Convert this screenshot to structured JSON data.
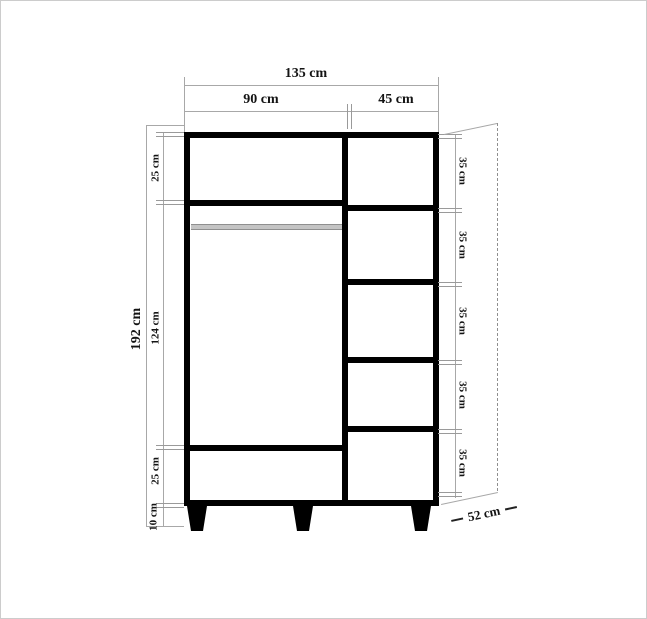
{
  "dimensions": {
    "top": {
      "total_width": "135 cm",
      "left_section_width": "90 cm",
      "right_section_width": "45 cm"
    },
    "left": {
      "total_height": "192 cm",
      "top_compartment": "25 cm",
      "middle_compartment": "124 cm",
      "bottom_compartment": "25 cm",
      "legs_height": "10 cm"
    },
    "right": {
      "shelves": [
        "35 cm",
        "35 cm",
        "35 cm",
        "35 cm",
        "35 cm"
      ]
    },
    "depth": "52 cm"
  },
  "colors": {
    "outline": "#000000",
    "dimension_line": "#a8a8a8",
    "tick": "#9a9a9a",
    "text": "#141414",
    "rod": "#c4c4c4",
    "rod_edge": "#8f8f8f",
    "background": "#ffffff",
    "frame": "#cccccc"
  }
}
